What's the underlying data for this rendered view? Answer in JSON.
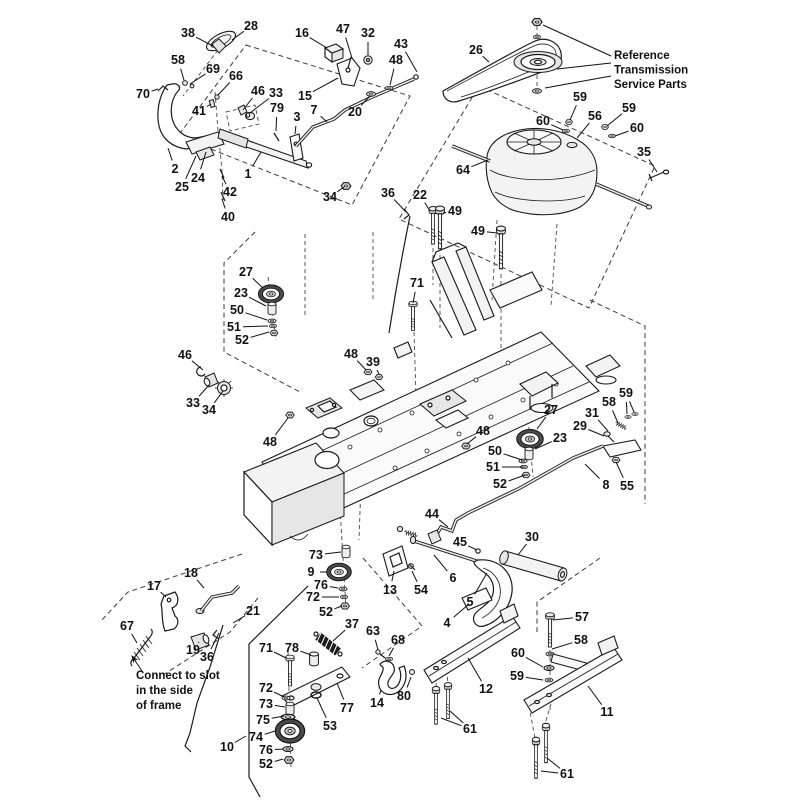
{
  "figure": {
    "title": "exploded-parts-diagram",
    "background": "#ffffff",
    "line_color": "#1a1a1a",
    "accent_dark": "#4a4a4a"
  },
  "annotations": [
    {
      "id": "reference-transmission-service-parts",
      "x": 614,
      "y": 59,
      "line_height": 14.5,
      "lines": [
        "Reference",
        "Transmission",
        "Service Parts"
      ],
      "leaders": [
        [
          611,
          56,
          543,
          25
        ],
        [
          611,
          63,
          557,
          69
        ],
        [
          611,
          76,
          545,
          88
        ]
      ]
    },
    {
      "id": "connect-to-slot",
      "x": 136,
      "y": 679,
      "line_height": 15,
      "lines": [
        "Connect to slot",
        "in the side",
        "of frame"
      ],
      "arrow": [
        142,
        671,
        132,
        656
      ]
    }
  ],
  "callouts": [
    {
      "n": "38",
      "x": 188,
      "y": 33,
      "t": [
        [
          213,
          46
        ]
      ]
    },
    {
      "n": "28",
      "x": 251,
      "y": 26,
      "t": [
        [
          232,
          40
        ]
      ]
    },
    {
      "n": "16",
      "x": 302,
      "y": 33,
      "t": [
        [
          327,
          48
        ]
      ]
    },
    {
      "n": "47",
      "x": 343,
      "y": 29,
      "t": [
        [
          352,
          58
        ]
      ]
    },
    {
      "n": "32",
      "x": 368,
      "y": 33,
      "t": [
        [
          368,
          55
        ]
      ]
    },
    {
      "n": "43",
      "x": 401,
      "y": 44,
      "t": [
        [
          417,
          72
        ]
      ]
    },
    {
      "n": "48",
      "x": 396,
      "y": 60,
      "t": [
        [
          390,
          85
        ]
      ]
    },
    {
      "n": "58",
      "x": 178,
      "y": 60,
      "t": [
        [
          184,
          80
        ]
      ]
    },
    {
      "n": "69",
      "x": 213,
      "y": 69,
      "t": [
        [
          190,
          84
        ]
      ]
    },
    {
      "n": "66",
      "x": 236,
      "y": 76,
      "t": [
        [
          218,
          95
        ]
      ]
    },
    {
      "n": "70",
      "x": 143,
      "y": 94,
      "t": [
        [
          158,
          89
        ]
      ]
    },
    {
      "n": "41",
      "x": 199,
      "y": 111,
      "t": [
        [
          211,
          104
        ]
      ]
    },
    {
      "n": "46",
      "x": 258,
      "y": 91,
      "t": [
        [
          243,
          110
        ]
      ]
    },
    {
      "n": "33",
      "x": 276,
      "y": 93,
      "t": [
        [
          250,
          113
        ]
      ]
    },
    {
      "n": "79",
      "x": 277,
      "y": 108,
      "t": [
        [
          276,
          131
        ]
      ]
    },
    {
      "n": "15",
      "x": 305,
      "y": 96,
      "t": [
        [
          338,
          78
        ]
      ]
    },
    {
      "n": "3",
      "x": 297,
      "y": 117,
      "t": [
        [
          295,
          134
        ]
      ]
    },
    {
      "n": "7",
      "x": 314,
      "y": 110,
      "t": [
        [
          327,
          122
        ]
      ]
    },
    {
      "n": "20",
      "x": 355,
      "y": 112,
      "t": [
        [
          370,
          96
        ]
      ]
    },
    {
      "n": "2",
      "x": 175,
      "y": 169,
      "t": [
        [
          168,
          148
        ]
      ]
    },
    {
      "n": "25",
      "x": 182,
      "y": 187,
      "t": [
        [
          196,
          156
        ]
      ]
    },
    {
      "n": "24",
      "x": 198,
      "y": 178,
      "t": [
        [
          206,
          152
        ]
      ]
    },
    {
      "n": "1",
      "x": 248,
      "y": 174,
      "t": [
        [
          261,
          152
        ]
      ]
    },
    {
      "n": "42",
      "x": 230,
      "y": 192,
      "t": [
        [
          222,
          176
        ]
      ]
    },
    {
      "n": "40",
      "x": 228,
      "y": 217,
      "t": [
        [
          222,
          199
        ]
      ]
    },
    {
      "n": "34",
      "x": 330,
      "y": 197,
      "t": [
        [
          344,
          187
        ]
      ]
    },
    {
      "n": "36",
      "x": 388,
      "y": 193,
      "t": [
        [
          406,
          212
        ]
      ]
    },
    {
      "n": "22",
      "x": 420,
      "y": 195,
      "t": [
        [
          430,
          211
        ]
      ]
    },
    {
      "n": "26",
      "x": 476,
      "y": 50,
      "t": [
        [
          489,
          62
        ]
      ]
    },
    {
      "n": "59",
      "x": 580,
      "y": 97,
      "t": [
        [
          570,
          120
        ]
      ]
    },
    {
      "n": "60",
      "x": 543,
      "y": 121,
      "t": [
        [
          563,
          130
        ]
      ]
    },
    {
      "n": "56",
      "x": 595,
      "y": 116,
      "t": [
        [
          577,
          138
        ]
      ]
    },
    {
      "n": "59",
      "x": 629,
      "y": 108,
      "t": [
        [
          607,
          126
        ]
      ]
    },
    {
      "n": "60",
      "x": 637,
      "y": 128,
      "t": [
        [
          615,
          136
        ]
      ]
    },
    {
      "n": "35",
      "x": 644,
      "y": 152,
      "t": [
        [
          657,
          172
        ]
      ]
    },
    {
      "n": "64",
      "x": 463,
      "y": 170,
      "t": [
        [
          488,
          160
        ]
      ]
    },
    {
      "n": "49",
      "x": 455,
      "y": 211,
      "t": [
        [
          443,
          213
        ]
      ]
    },
    {
      "n": "49",
      "x": 478,
      "y": 231,
      "t": [
        [
          497,
          233
        ]
      ]
    },
    {
      "n": "71",
      "x": 417,
      "y": 283,
      "t": [
        [
          413,
          303
        ]
      ]
    },
    {
      "n": "27",
      "x": 246,
      "y": 272,
      "t": [
        [
          263,
          288
        ]
      ]
    },
    {
      "n": "23",
      "x": 241,
      "y": 293,
      "t": [
        [
          266,
          306
        ]
      ]
    },
    {
      "n": "50",
      "x": 237,
      "y": 310,
      "t": [
        [
          267,
          320
        ]
      ]
    },
    {
      "n": "51",
      "x": 234,
      "y": 327,
      "t": [
        [
          268,
          326
        ]
      ]
    },
    {
      "n": "52",
      "x": 242,
      "y": 340,
      "t": [
        [
          269,
          332
        ]
      ]
    },
    {
      "n": "46",
      "x": 185,
      "y": 355,
      "t": [
        [
          203,
          370
        ]
      ]
    },
    {
      "n": "33",
      "x": 193,
      "y": 403,
      "t": [
        [
          209,
          385
        ]
      ]
    },
    {
      "n": "34",
      "x": 209,
      "y": 410,
      "t": [
        [
          223,
          391
        ]
      ]
    },
    {
      "n": "48",
      "x": 351,
      "y": 354,
      "t": [
        [
          366,
          370
        ]
      ]
    },
    {
      "n": "39",
      "x": 373,
      "y": 362,
      "t": [
        [
          379,
          374
        ]
      ]
    },
    {
      "n": "48",
      "x": 270,
      "y": 442,
      "t": [
        [
          288,
          418
        ]
      ]
    },
    {
      "n": "48",
      "x": 483,
      "y": 431,
      "t": [
        [
          467,
          444
        ]
      ]
    },
    {
      "n": "27",
      "x": 551,
      "y": 410,
      "t": [
        [
          537,
          429
        ]
      ]
    },
    {
      "n": "23",
      "x": 560,
      "y": 438,
      "t": [
        [
          535,
          449
        ]
      ]
    },
    {
      "n": "50",
      "x": 495,
      "y": 451,
      "t": [
        [
          522,
          460
        ]
      ]
    },
    {
      "n": "51",
      "x": 493,
      "y": 467,
      "t": [
        [
          523,
          467
        ]
      ]
    },
    {
      "n": "52",
      "x": 500,
      "y": 484,
      "t": [
        [
          525,
          475
        ]
      ]
    },
    {
      "n": "29",
      "x": 580,
      "y": 426,
      "t": [
        [
          604,
          436
        ]
      ]
    },
    {
      "n": "31",
      "x": 592,
      "y": 413,
      "t": [
        [
          608,
          431
        ]
      ]
    },
    {
      "n": "58",
      "x": 609,
      "y": 402,
      "t": [
        [
          618,
          423
        ]
      ]
    },
    {
      "n": "59",
      "x": 626,
      "y": 393,
      "t": [
        [
          627,
          414
        ],
        [
          634,
          412
        ]
      ]
    },
    {
      "n": "8",
      "x": 606,
      "y": 485,
      "t": [
        [
          585,
          464
        ]
      ]
    },
    {
      "n": "55",
      "x": 627,
      "y": 486,
      "t": [
        [
          616,
          462
        ]
      ]
    },
    {
      "n": "44",
      "x": 432,
      "y": 514,
      "t": [
        [
          448,
          527
        ]
      ]
    },
    {
      "n": "45",
      "x": 460,
      "y": 542,
      "t": [
        [
          477,
          550
        ]
      ]
    },
    {
      "n": "30",
      "x": 532,
      "y": 537,
      "t": [
        [
          518,
          555
        ]
      ]
    },
    {
      "n": "6",
      "x": 453,
      "y": 578,
      "t": [
        [
          434,
          555
        ]
      ]
    },
    {
      "n": "13",
      "x": 390,
      "y": 590,
      "t": [
        [
          394,
          571
        ]
      ]
    },
    {
      "n": "54",
      "x": 421,
      "y": 590,
      "t": [
        [
          412,
          571
        ]
      ]
    },
    {
      "n": "5",
      "x": 470,
      "y": 602,
      "t": [
        [
          487,
          573
        ]
      ]
    },
    {
      "n": "4",
      "x": 447,
      "y": 623,
      "t": [
        [
          469,
          604
        ]
      ]
    },
    {
      "n": "9",
      "x": 311,
      "y": 572,
      "t": [
        [
          327,
          572
        ]
      ]
    },
    {
      "n": "73",
      "x": 316,
      "y": 555,
      "t": [
        [
          341,
          552
        ]
      ]
    },
    {
      "n": "76",
      "x": 321,
      "y": 585,
      "t": [
        [
          338,
          588
        ]
      ]
    },
    {
      "n": "72",
      "x": 313,
      "y": 597,
      "t": [
        [
          339,
          597
        ]
      ]
    },
    {
      "n": "52",
      "x": 326,
      "y": 612,
      "t": [
        [
          342,
          606
        ]
      ]
    },
    {
      "n": "18",
      "x": 191,
      "y": 573,
      "t": [
        [
          204,
          588
        ]
      ]
    },
    {
      "n": "17",
      "x": 154,
      "y": 586,
      "t": [
        [
          166,
          597
        ]
      ]
    },
    {
      "n": "67",
      "x": 127,
      "y": 626,
      "t": [
        [
          137,
          643
        ]
      ]
    },
    {
      "n": "19",
      "x": 193,
      "y": 650,
      "t": [
        [
          199,
          642
        ]
      ]
    },
    {
      "n": "36",
      "x": 207,
      "y": 657,
      "t": [
        [
          219,
          633
        ]
      ]
    },
    {
      "n": "21",
      "x": 253,
      "y": 611,
      "t": [
        [
          233,
          623
        ]
      ]
    },
    {
      "n": "37",
      "x": 352,
      "y": 624,
      "t": [
        [
          333,
          641
        ]
      ]
    },
    {
      "n": "71",
      "x": 266,
      "y": 648,
      "t": [
        [
          286,
          658
        ]
      ]
    },
    {
      "n": "78",
      "x": 292,
      "y": 648,
      "t": [
        [
          311,
          655
        ]
      ]
    },
    {
      "n": "72",
      "x": 266,
      "y": 688,
      "t": [
        [
          284,
          697
        ]
      ]
    },
    {
      "n": "73",
      "x": 266,
      "y": 704,
      "t": [
        [
          285,
          707
        ]
      ]
    },
    {
      "n": "75",
      "x": 263,
      "y": 720,
      "t": [
        [
          284,
          716
        ]
      ]
    },
    {
      "n": "74",
      "x": 256,
      "y": 737,
      "t": [
        [
          275,
          731
        ]
      ]
    },
    {
      "n": "76",
      "x": 266,
      "y": 750,
      "t": [
        [
          283,
          749
        ]
      ]
    },
    {
      "n": "52",
      "x": 266,
      "y": 764,
      "t": [
        [
          283,
          759
        ]
      ]
    },
    {
      "n": "10",
      "x": 227,
      "y": 747,
      "t": [
        [
          246,
          736
        ]
      ]
    },
    {
      "n": "77",
      "x": 347,
      "y": 708,
      "t": [
        [
          337,
          683
        ]
      ]
    },
    {
      "n": "53",
      "x": 330,
      "y": 726,
      "t": [
        [
          317,
          698
        ]
      ]
    },
    {
      "n": "63",
      "x": 373,
      "y": 631,
      "t": [
        [
          378,
          650
        ]
      ]
    },
    {
      "n": "68",
      "x": 398,
      "y": 640,
      "t": [
        [
          389,
          656
        ]
      ]
    },
    {
      "n": "14",
      "x": 377,
      "y": 703,
      "t": [
        [
          381,
          690
        ]
      ]
    },
    {
      "n": "80",
      "x": 404,
      "y": 696,
      "t": [
        [
          411,
          677
        ]
      ]
    },
    {
      "n": "57",
      "x": 582,
      "y": 617,
      "t": [
        [
          553,
          620
        ]
      ]
    },
    {
      "n": "58",
      "x": 581,
      "y": 640,
      "t": [
        [
          552,
          649
        ]
      ]
    },
    {
      "n": "60",
      "x": 518,
      "y": 653,
      "t": [
        [
          543,
          667
        ]
      ]
    },
    {
      "n": "59",
      "x": 517,
      "y": 676,
      "t": [
        [
          543,
          680
        ]
      ]
    },
    {
      "n": "12",
      "x": 486,
      "y": 689,
      "t": [
        [
          468,
          658
        ]
      ]
    },
    {
      "n": "61",
      "x": 470,
      "y": 729,
      "t": [
        [
          441,
          718
        ],
        [
          450,
          711
        ]
      ]
    },
    {
      "n": "11",
      "x": 607,
      "y": 712,
      "t": [
        [
          588,
          686
        ]
      ]
    },
    {
      "n": "61",
      "x": 567,
      "y": 774,
      "t": [
        [
          541,
          771
        ],
        [
          547,
          758
        ]
      ]
    }
  ]
}
